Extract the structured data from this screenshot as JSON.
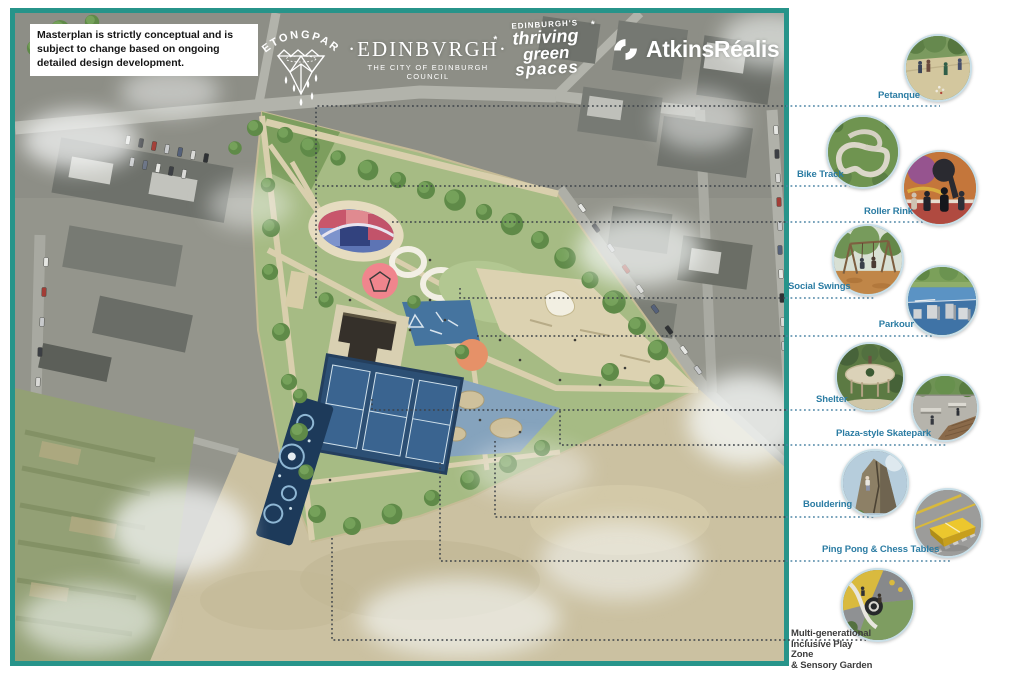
{
  "disclaimer": "Masterplan is strictly conceptual and is subject to change based on ongoing detailed design development.",
  "logos": {
    "betongpark": {
      "text": "BETONGPARK"
    },
    "edinburgh": {
      "name": "·EDINBVRGH·",
      "subtitle": "THE CITY OF EDINBURGH COUNCIL"
    },
    "green_spaces": {
      "line1": "EDINBURGH'S",
      "line2": "thriving",
      "line3": "green",
      "line4": "spaces"
    },
    "atkinsrealis": {
      "name": "AtkinsRéalis"
    }
  },
  "callouts": [
    {
      "label": "Petanque"
    },
    {
      "label": "Bike Track"
    },
    {
      "label": "Roller Rink"
    },
    {
      "label": "Social Swings"
    },
    {
      "label": "Parkour"
    },
    {
      "label": "Shelter"
    },
    {
      "label": "Plaza-style Skatepark"
    },
    {
      "label": "Bouldering"
    },
    {
      "label": "Ping Pong & Chess Tables"
    },
    {
      "label_lines": [
        "Multi-generational",
        "Inclusive Play Zone",
        "& Sensory Garden"
      ]
    }
  ],
  "icons": {
    "sparkle": "*"
  },
  "colors": {
    "frame_teal": "#27948a",
    "label_blue": "#2b7ca3",
    "label_dark": "#3d3d3d"
  }
}
